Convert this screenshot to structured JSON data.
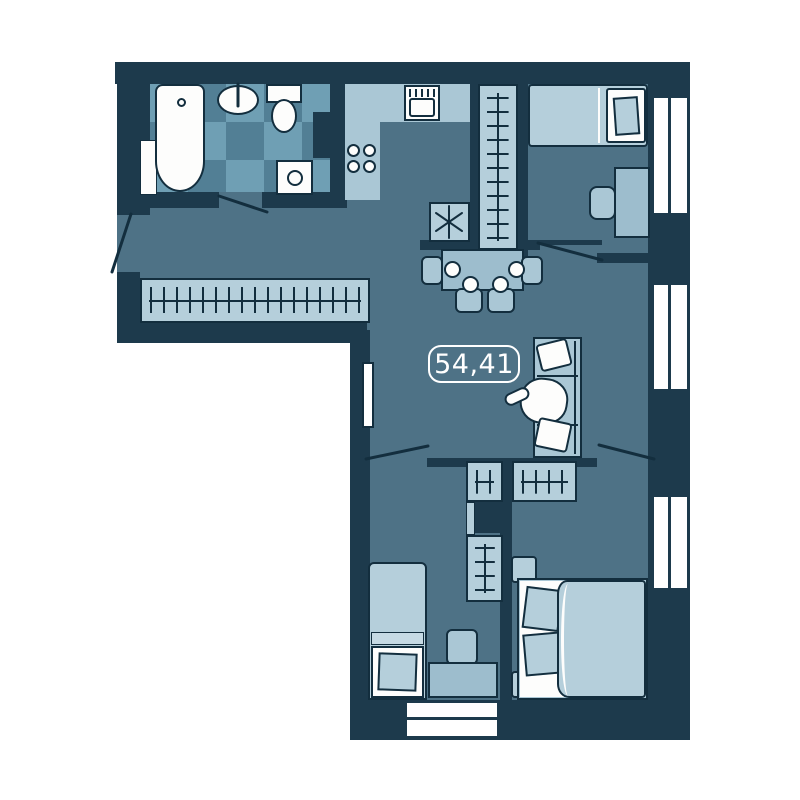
{
  "plan": {
    "area_label": "54,41"
  },
  "colors": {
    "background": "#ffffff",
    "wall": "#1d3a4c",
    "line": "#132e3e",
    "floor": "#4e7286",
    "furn": "#b5cfdb",
    "furn2": "#9dbdcd",
    "furn3": "#aac7d5",
    "white": "#fdfdfc",
    "tile-l": "#6f9fb4",
    "tile-d": "#527f95",
    "fold": "#c6dae4",
    "label-text": "#ffffff",
    "label-border": "#ffffff"
  }
}
